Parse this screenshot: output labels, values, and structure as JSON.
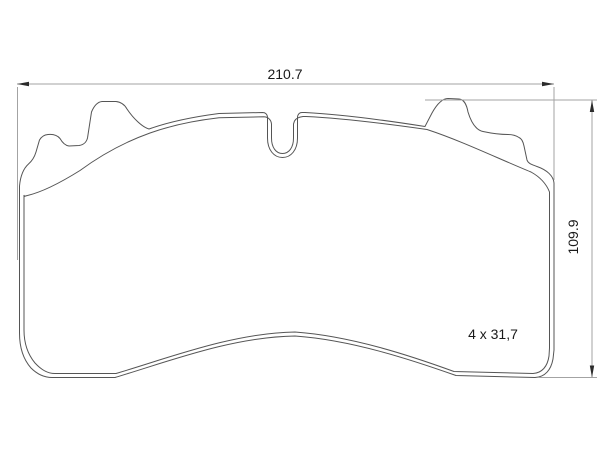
{
  "drawing": {
    "type": "brake-pad-outline-technical-drawing",
    "dimensions": {
      "width_label": "210.7",
      "height_label": "109.9",
      "thickness_label": "4 x 31,7"
    },
    "colors": {
      "background": "#ffffff",
      "outline": "#555555",
      "dimension_line": "#a3a3a3",
      "arrow": "#2b2b2b",
      "text": "#1a1a1a"
    }
  }
}
